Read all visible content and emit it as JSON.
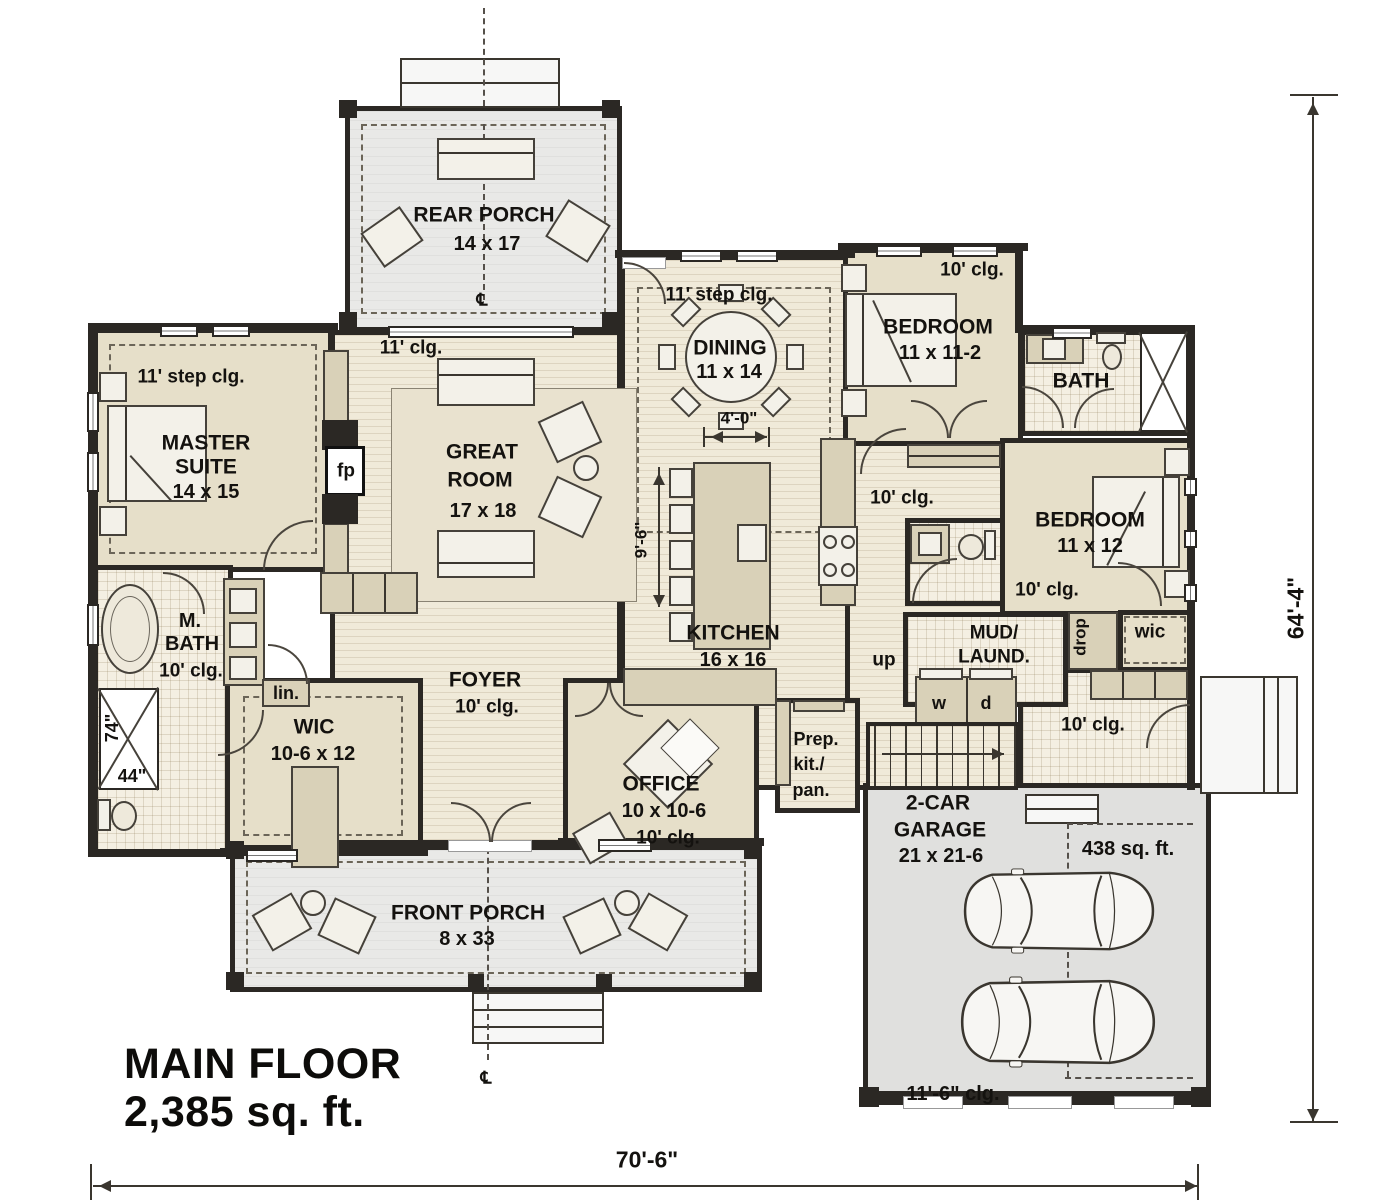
{
  "meta": {
    "plan_title_line1": "MAIN FLOOR",
    "plan_title_line2": "2,385 sq. ft."
  },
  "dimensions": {
    "overall_width": "70'-6\"",
    "overall_height": "64'-4\"",
    "kitchen_island_length": "9'-6\"",
    "island_clearance": "4'-0\"",
    "shower_length": "74\"",
    "shower_width": "44\""
  },
  "rooms": {
    "rear_porch": {
      "name": "REAR PORCH",
      "size": "14 x 17"
    },
    "master_suite": {
      "name_line1": "MASTER",
      "name_line2": "SUITE",
      "size": "14 x 15",
      "ceiling": "11' step clg."
    },
    "great_room": {
      "name_line1": "GREAT",
      "name_line2": "ROOM",
      "size": "17 x 18",
      "ceiling": "11' clg."
    },
    "dining": {
      "name": "DINING",
      "size": "11 x 14",
      "ceiling": "11' step clg."
    },
    "kitchen": {
      "name": "KITCHEN",
      "size": "16 x 16"
    },
    "bedroom_2": {
      "name": "BEDROOM",
      "size": "11 x 11-2",
      "ceiling": "10' clg."
    },
    "bath_2": {
      "name": "BATH"
    },
    "bedroom_3": {
      "name": "BEDROOM",
      "size": "11 x 12",
      "ceiling": "10' clg."
    },
    "hall": {
      "ceiling": "10' clg."
    },
    "mud_laundry": {
      "name_line1": "MUD/",
      "name_line2": "LAUND.",
      "washer": "w",
      "dryer": "d"
    },
    "garage_hall": {
      "ceiling": "10' clg."
    },
    "wic_right": {
      "name": "wic"
    },
    "drop_zone": {
      "name": "drop"
    },
    "prep_pantry": {
      "line1": "Prep.",
      "line2": "kit./",
      "line3": "pan."
    },
    "office": {
      "name": "OFFICE",
      "size": "10 x 10-6",
      "ceiling": "10' clg."
    },
    "foyer": {
      "name": "FOYER",
      "ceiling": "10' clg."
    },
    "wic_left": {
      "name": "WIC",
      "size": "10-6 x 12"
    },
    "master_bath": {
      "name_line1": "M.",
      "name_line2": "BATH",
      "ceiling": "10' clg."
    },
    "linen": {
      "name": "lin."
    },
    "front_porch": {
      "name": "FRONT PORCH",
      "size": "8 x 33"
    },
    "garage": {
      "name_line1": "2-CAR",
      "name_line2": "GARAGE",
      "size": "21 x 21-6",
      "area": "438 sq. ft.",
      "ceiling": "11'-6\" clg."
    },
    "stairs": {
      "direction": "up"
    }
  },
  "symbols": {
    "fireplace": "fp",
    "centerline": "℄"
  },
  "colors": {
    "wall": "#2b2824",
    "room_fill": "#e6dfc9",
    "wood_floor": "#f0ead9",
    "tile_floor": "#f4efe2",
    "porch": "#e9e9e7",
    "garage": "#e0e0de",
    "furniture_tan": "#d9d1b8",
    "furniture_light": "#f3f1e9"
  }
}
